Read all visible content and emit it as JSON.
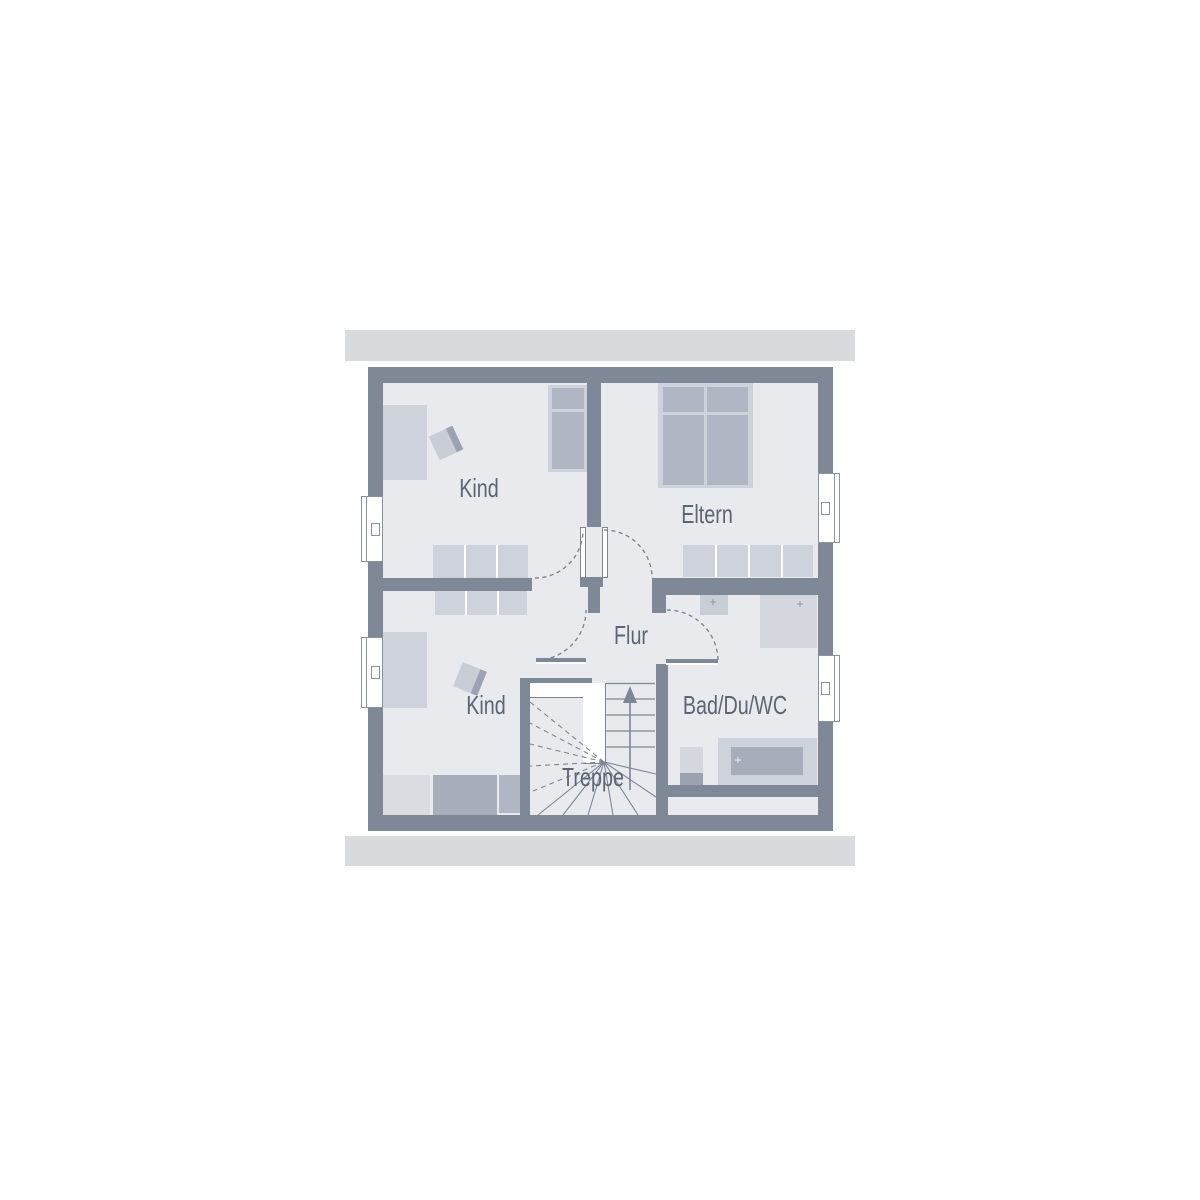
{
  "plan": {
    "type": "floor-plan",
    "floor": "upper",
    "rooms": [
      {
        "id": "kind-top",
        "label": "Kind"
      },
      {
        "id": "eltern",
        "label": "Eltern"
      },
      {
        "id": "kind-bottom",
        "label": "Kind"
      },
      {
        "id": "flur",
        "label": "Flur"
      },
      {
        "id": "bad",
        "label": "Bad/Du/WC"
      },
      {
        "id": "treppe",
        "label": "Treppe"
      }
    ],
    "marks": {
      "plus": "+"
    },
    "fixtures": [
      "wardrobe",
      "desk-chair",
      "bed",
      "double-bed",
      "dresser-row",
      "washbasin",
      "shower",
      "wc",
      "bathtub",
      "stairs-winder",
      "up-arrow"
    ],
    "windows": 4,
    "doors": 4,
    "colors": {
      "wall": "#7f8897",
      "floor": "#e8eaee",
      "roof_band": "#d8dade",
      "furniture_light": "#ced2da",
      "furniture_medium": "#b0b6c4",
      "furniture_dark": "#a8aebc",
      "line": "#7d8695",
      "label_text": "#5c6574",
      "background": "#ffffff"
    }
  }
}
